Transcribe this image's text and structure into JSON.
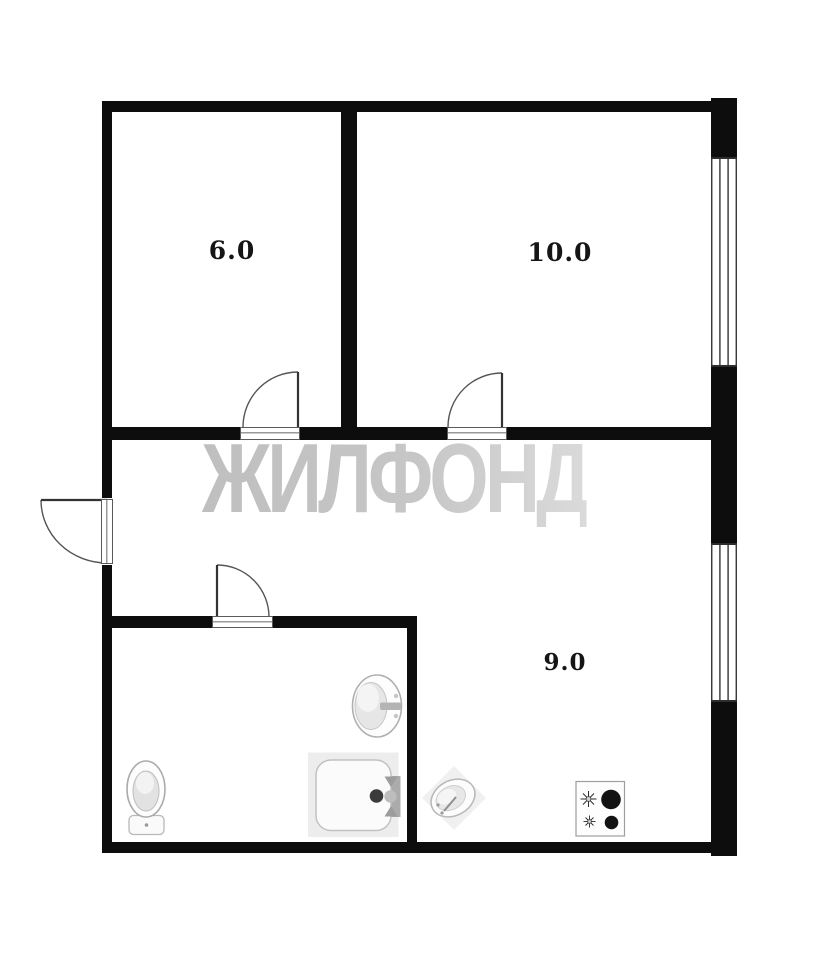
{
  "watermark": {
    "text": "ЖИЛФОНД"
  },
  "rooms": [
    {
      "name": "room-top-left",
      "area": "6.0"
    },
    {
      "name": "room-top-right",
      "area": "10.0"
    },
    {
      "name": "kitchen",
      "area": "9.0"
    }
  ],
  "fixtures": [
    {
      "name": "toilet"
    },
    {
      "name": "bathroom-sink"
    },
    {
      "name": "bathtub-shower-tray"
    },
    {
      "name": "kitchen-sink"
    },
    {
      "name": "stove-two-burners"
    }
  ],
  "features": {
    "doors": 4,
    "windows": 2
  },
  "colors": {
    "wall": "#0d0d0d",
    "background": "#ffffff",
    "watermark": "#c4c4c4",
    "fixture_stroke": "#b0b0b0"
  }
}
